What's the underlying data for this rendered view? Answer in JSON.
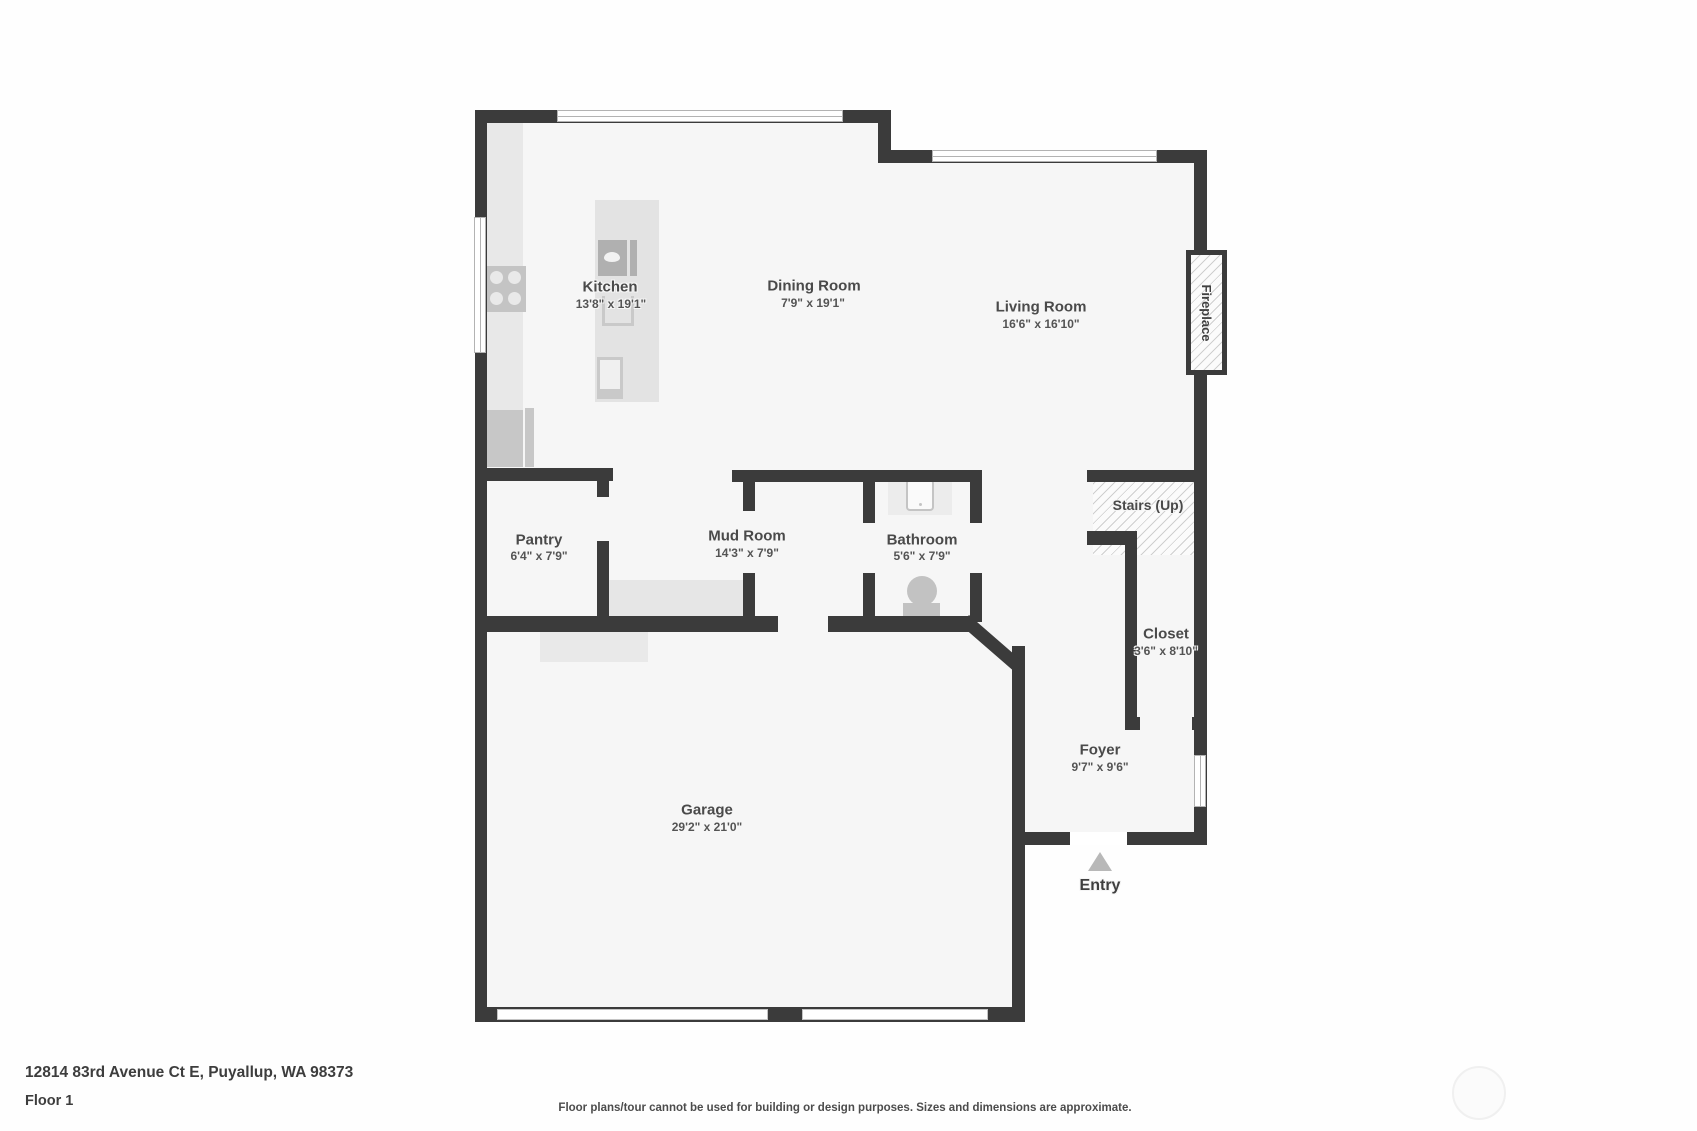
{
  "rooms": {
    "kitchen": {
      "name": "Kitchen",
      "dims": "13'8\" x 19'1\""
    },
    "dining_room": {
      "name": "Dining Room",
      "dims": "7'9\" x 19'1\""
    },
    "living_room": {
      "name": "Living Room",
      "dims": "16'6\" x 16'10\""
    },
    "pantry": {
      "name": "Pantry",
      "dims": "6'4\" x 7'9\""
    },
    "mud_room": {
      "name": "Mud Room",
      "dims": "14'3\" x 7'9\""
    },
    "bathroom": {
      "name": "Bathroom",
      "dims": "5'6\" x 7'9\""
    },
    "closet": {
      "name": "Closet",
      "dims": "3'6\" x 8'10\""
    },
    "foyer": {
      "name": "Foyer",
      "dims": "9'7\" x 9'6\""
    },
    "garage": {
      "name": "Garage",
      "dims": "29'2\" x 21'0\""
    }
  },
  "labels": {
    "stairs": "Stairs (Up)",
    "fireplace": "Fireplace",
    "entry": "Entry"
  },
  "footer": {
    "address": "12814 83rd Avenue Ct E, Puyallup, WA 98373",
    "floor": "Floor 1",
    "disclaimer": "Floor plans/tour cannot be used for building or design purposes. Sizes and dimensions are approximate."
  },
  "icons": {
    "stove": "stove-burners-icon",
    "refrigerator": "refrigerator-icon",
    "island_sink": "sink-icon",
    "dishwasher": "dishwasher-icon",
    "bathroom_sink": "bathroom-sink-icon",
    "toilet": "toilet-icon",
    "entry_arrow": "entry-arrow-icon",
    "watermark": "watermark-logo"
  },
  "colors": {
    "wall": "#3b3b3b",
    "floor": "#f6f6f6",
    "furniture": "#e5e5e5",
    "appliance": "#c4c4c4",
    "label_text": "#4a4a4a",
    "hatch_line": "#cfcfcf",
    "entry_arrow": "#b8b8b8"
  }
}
